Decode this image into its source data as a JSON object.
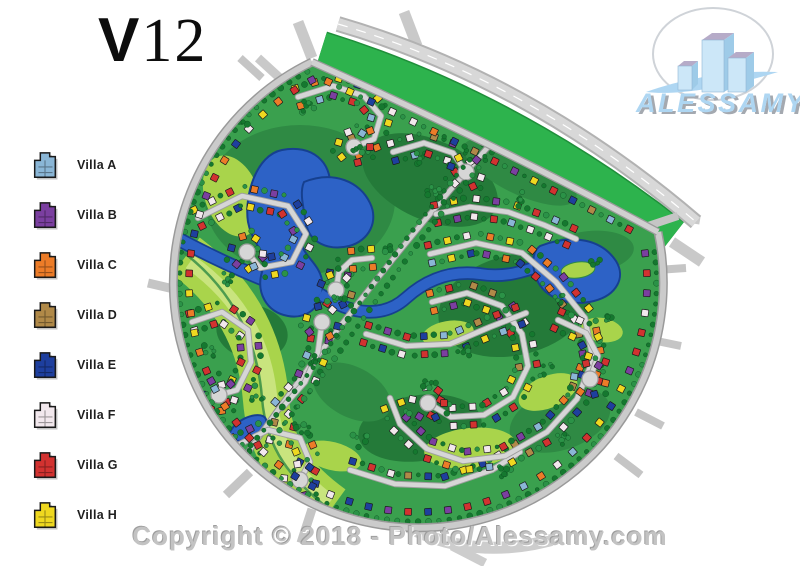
{
  "title": "V12",
  "legend": {
    "items": [
      {
        "label": "Villa A",
        "color": "#8ab6d6"
      },
      {
        "label": "Villa B",
        "color": "#7b3fa0"
      },
      {
        "label": "Villa C",
        "color": "#ec7c28"
      },
      {
        "label": "Villa D",
        "color": "#b08948"
      },
      {
        "label": "Villa E",
        "color": "#1e3f9e"
      },
      {
        "label": "Villa F",
        "color": "#f2e8ed"
      },
      {
        "label": "Villa G",
        "color": "#d23230"
      },
      {
        "label": "Villa H",
        "color": "#efd820"
      }
    ]
  },
  "logo": {
    "brand": "ALESSAMY",
    "accent": "#aed6f2",
    "shadow": "#a4a9b0"
  },
  "footer": {
    "copyright": "Copyright © 2018 - Photo/Alessamy.com"
  },
  "map": {
    "colors": {
      "base": "#3aa04e",
      "mid": "#2f8a44",
      "dark": "#247a39",
      "light": "#a9d44b",
      "lighter": "#c9e47e",
      "band": "#2db34d",
      "water": "#2d62c6",
      "wedge": "#16408f",
      "road": "#d6d6d6",
      "redge": "#9e9e9e",
      "tree1": "#15782f",
      "tree2": "#2b9247"
    }
  }
}
